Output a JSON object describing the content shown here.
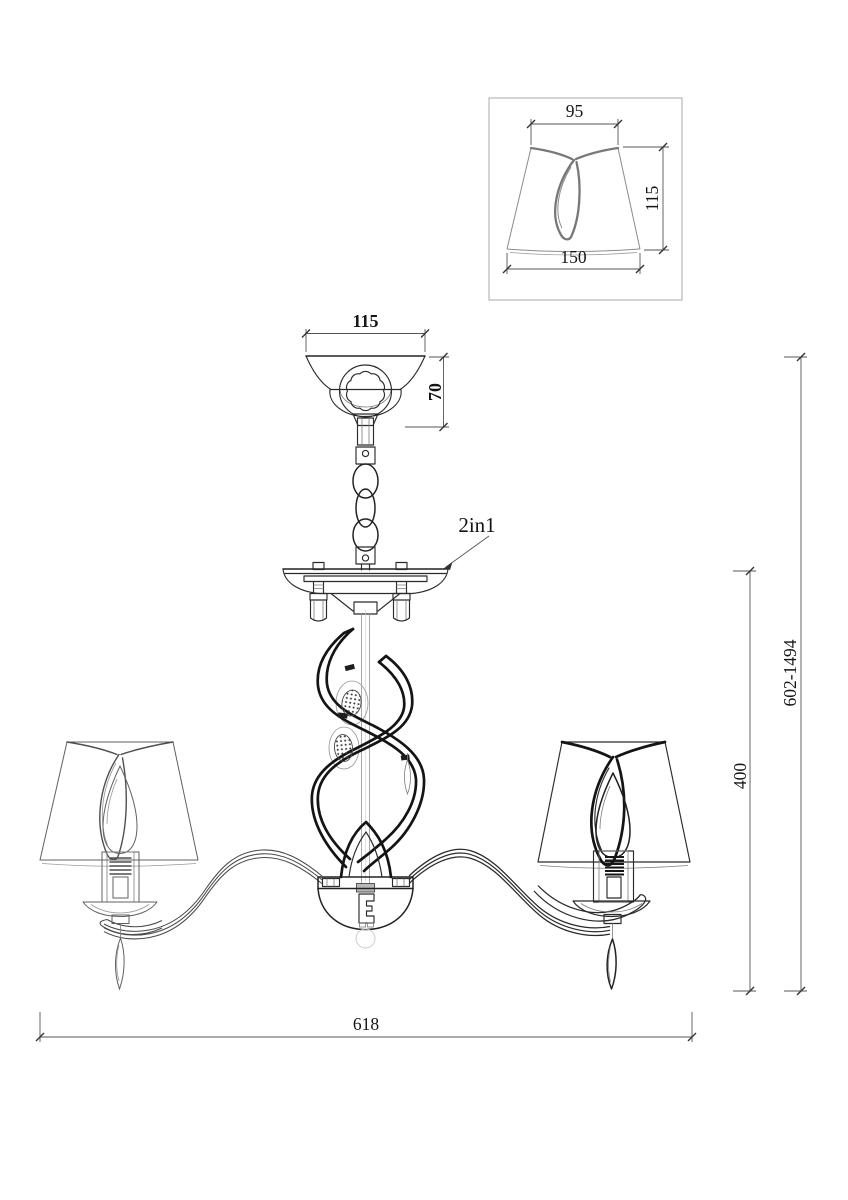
{
  "drawing": {
    "kind": "Chandelier technical dimension drawing",
    "background_color": "#ffffff",
    "line_color": "#1c1c1c",
    "label_2in1": "2in1",
    "inset_detail": {
      "shade_top_width_mm": "95",
      "shade_height_mm": "115",
      "shade_bottom_width_mm": "150"
    },
    "canopy": {
      "width_mm": "115",
      "height_mm": "70"
    },
    "overall": {
      "total_height_mm": "602-1494",
      "body_height_mm": "400",
      "total_width_mm": "618"
    }
  }
}
